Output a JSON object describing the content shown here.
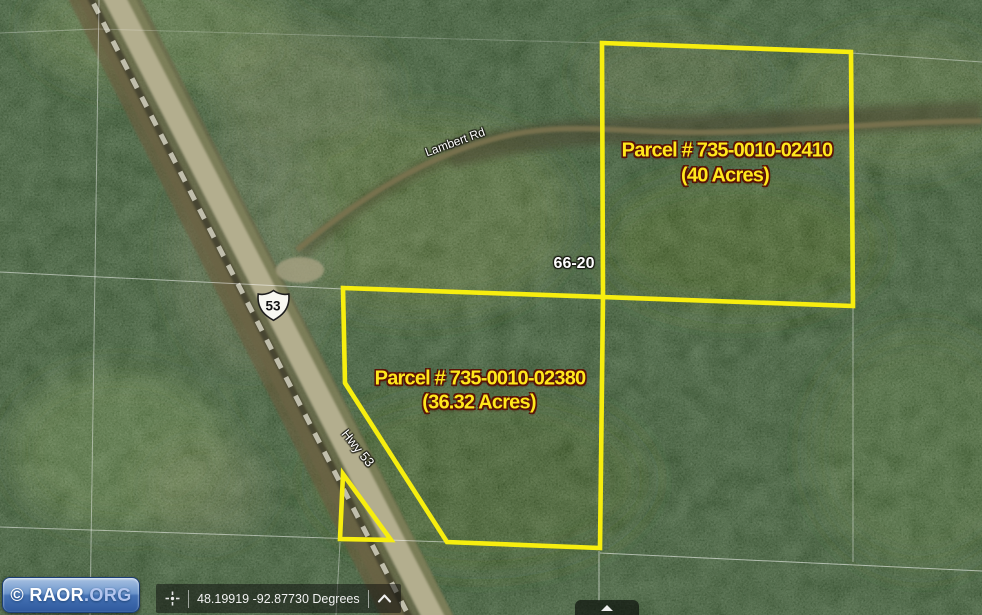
{
  "watermark": {
    "copyright": "© RAOR",
    "domain_suffix": ".ORG"
  },
  "status_bar": {
    "coordinates": "48.19919 -92.87730 Degrees"
  },
  "map": {
    "parcels": [
      {
        "parcel_label": "Parcel # 735-0010-02410",
        "acreage_label": "(40 Acres)"
      },
      {
        "parcel_label": "Parcel # 735-0010-02380",
        "acreage_label": "(36.32 Acres)"
      }
    ],
    "labels": {
      "road_1": "Lambert Rd",
      "road_2": "Hwy 53",
      "highway_shield": "53",
      "section_number": "66-20"
    }
  },
  "icons": {
    "crosshair": "crosshair-icon",
    "chevron_up": "chevron-up-icon",
    "expand_up": "expand-up-icon"
  },
  "colors": {
    "parcel_outline": "#f7ee0f",
    "parcel_label_text": "#ffe81c",
    "parcel_label_outline": "#5a1206",
    "map_label_text": "#ffffff",
    "watermark_blue": "#3a66a8",
    "status_bar_bg": "rgba(10,10,10,0.5)",
    "road_surface": "#b3ae8e",
    "forest_base": "#2c4526"
  }
}
